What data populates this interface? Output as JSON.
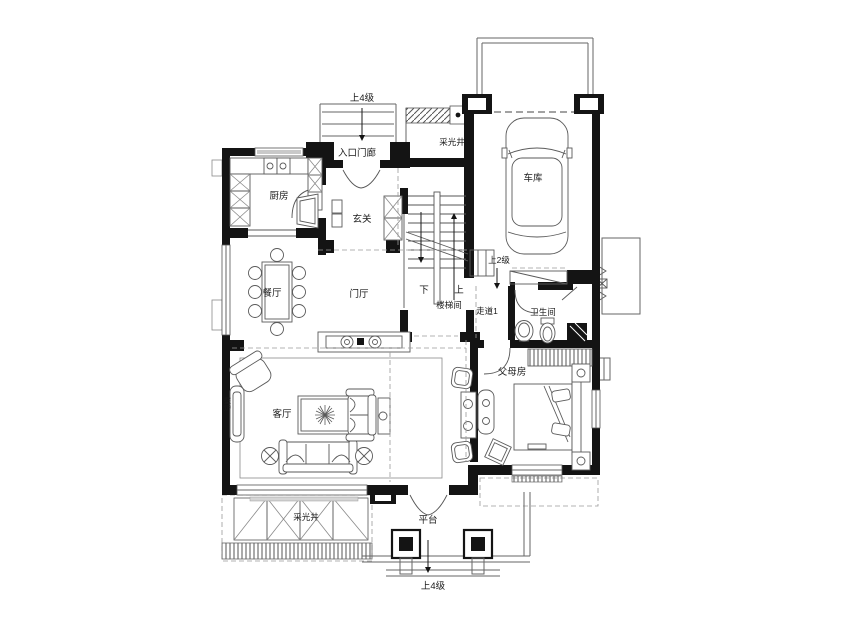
{
  "floor_plan": {
    "background": "#ffffff",
    "wall_color": "#141414",
    "line_color": "#5a5a5a",
    "labels": {
      "steps_up4_top": "上4级",
      "entry_porch": "入口门廊",
      "light_well_top": "采光井",
      "kitchen": "厨房",
      "foyer": "玄关",
      "garage": "车库",
      "dining_room": "餐厅",
      "entry_hall": "门厅",
      "stair_down": "下",
      "stair_up": "上",
      "stairwell": "楼梯间",
      "steps_up2": "上2级",
      "corridor": "走道1",
      "bathroom": "卫生间",
      "parents_room": "父母房",
      "living_room": "客厅",
      "fireplace": "壁炉",
      "light_well_bottom": "采光井",
      "platform": "平台",
      "steps_up4_bottom": "上4级"
    }
  }
}
